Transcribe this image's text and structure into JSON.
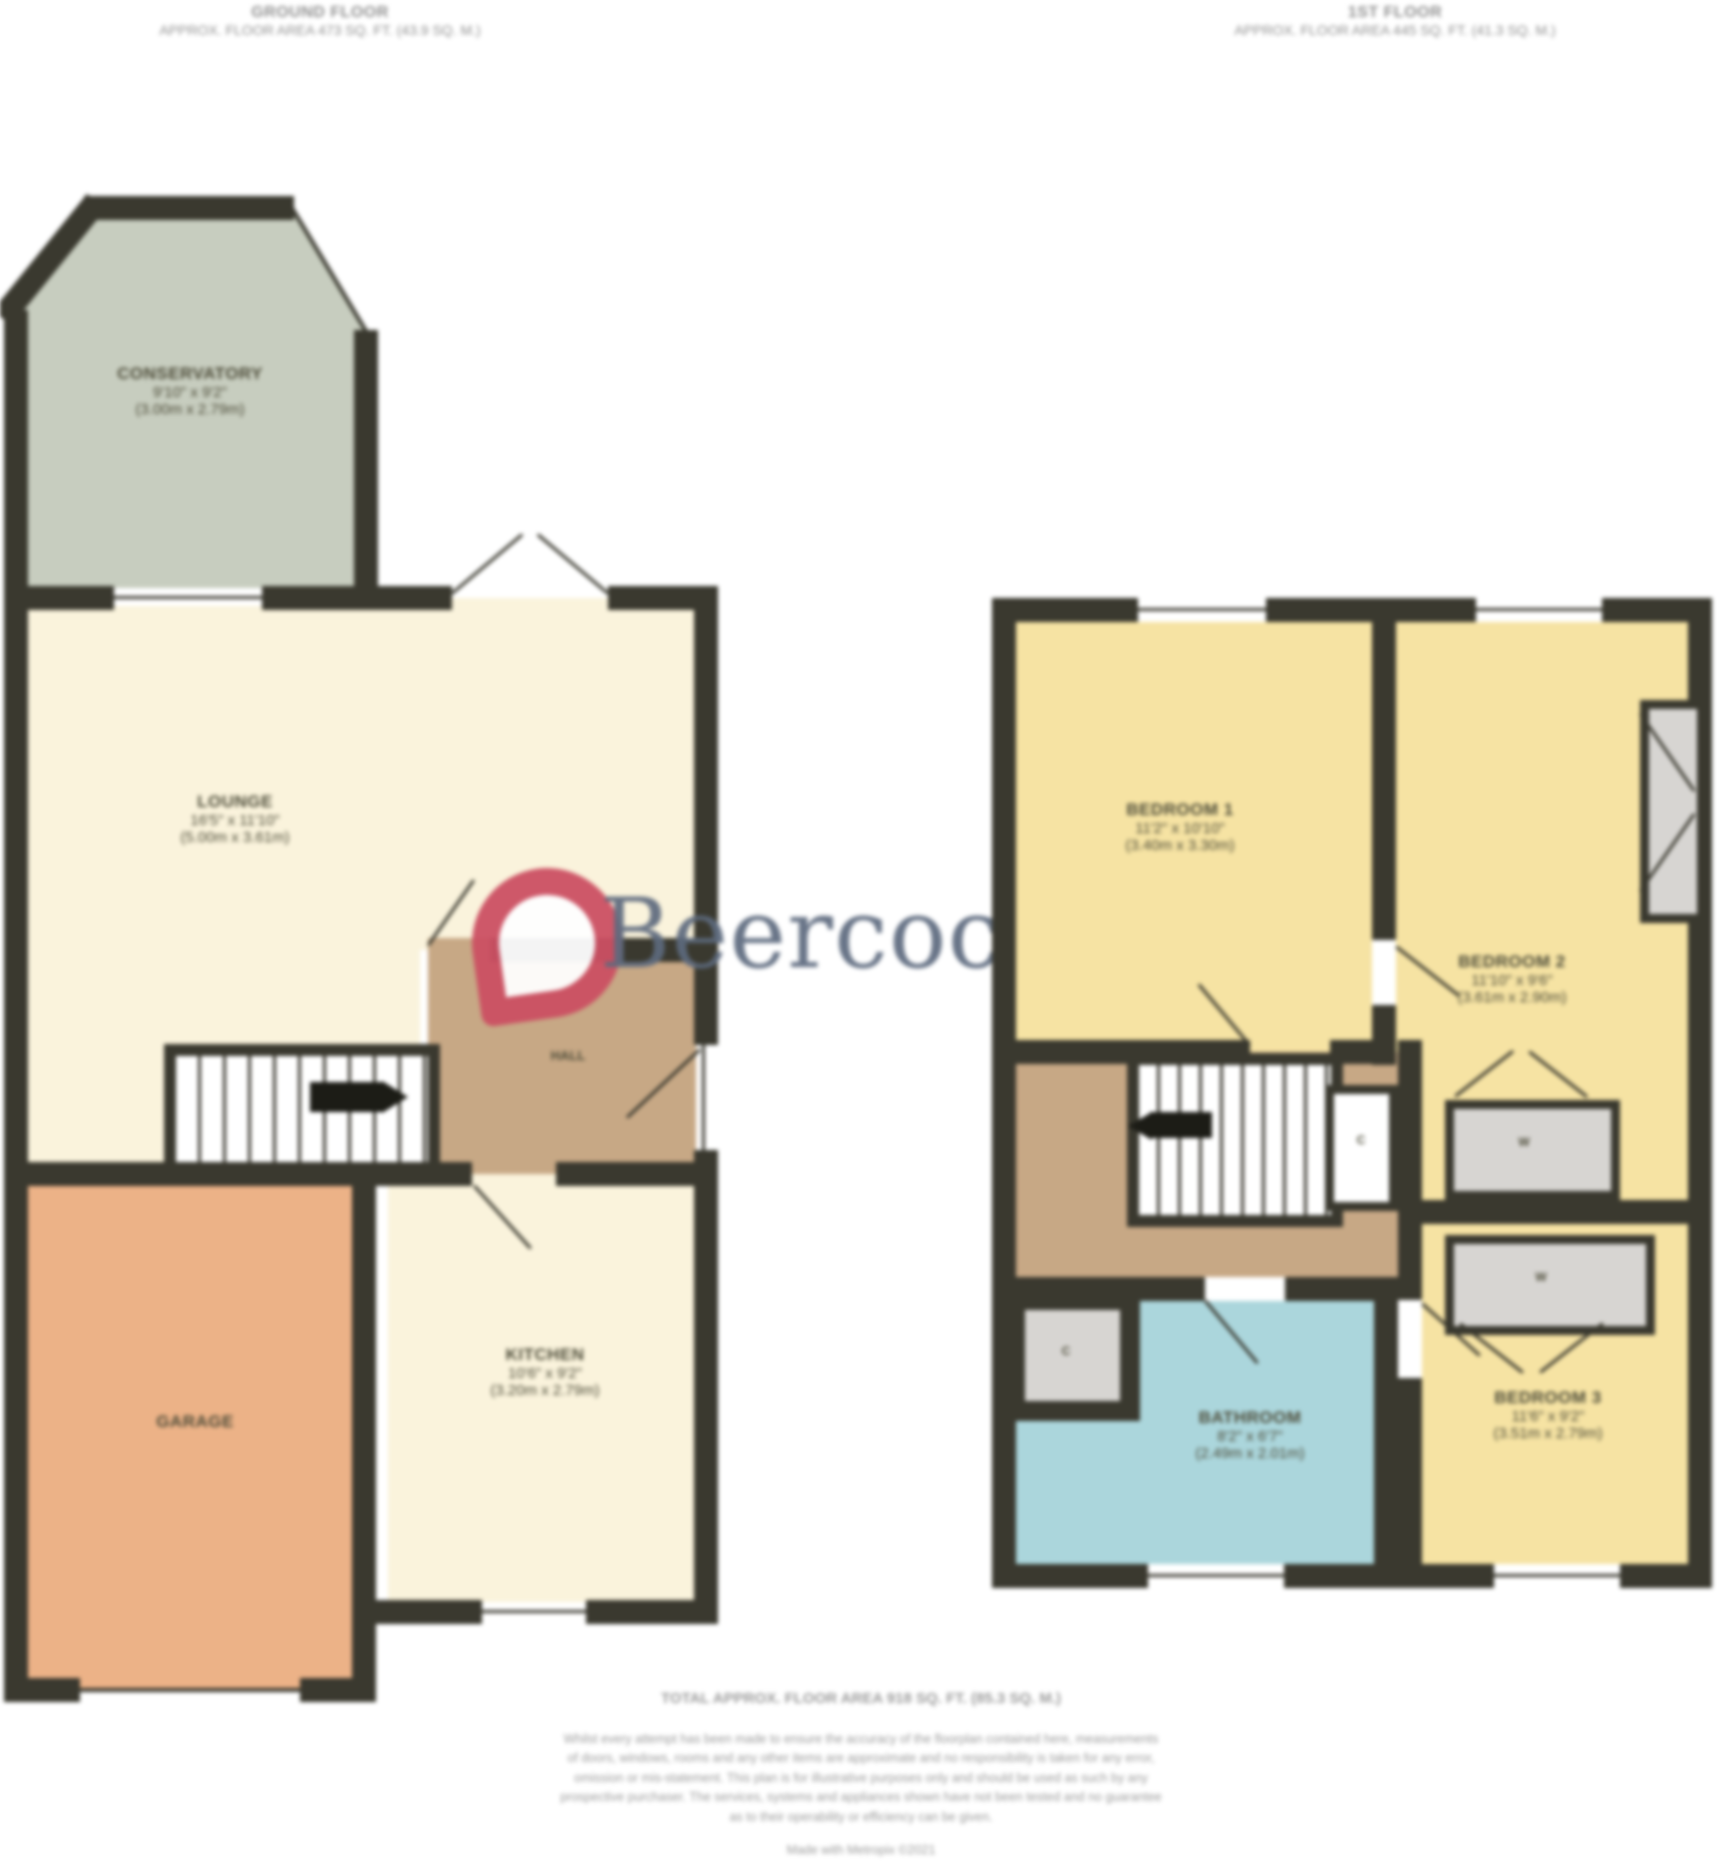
{
  "headers": {
    "ground": {
      "title": "GROUND FLOOR",
      "subtitle": "APPROX. FLOOR AREA 473 SQ. FT. (43.9 SQ. M.)"
    },
    "first": {
      "title": "1ST FLOOR",
      "subtitle": "APPROX. FLOOR AREA 445 SQ. FT. (41.3 SQ. M.)"
    }
  },
  "watermark": {
    "brand": "Beercocks",
    "text_color": "#5d6a7e",
    "logo_color": "#cc5063"
  },
  "ground": {
    "rooms": {
      "conservatory": {
        "name": "CONSERVATORY",
        "dims_ft": "9'10\" x 9'2\"",
        "dims_m": "(3.00m x 2.79m)"
      },
      "lounge": {
        "name": "LOUNGE",
        "dims_ft": "16'5\" x 11'10\"",
        "dims_m": "(5.00m x 3.61m)"
      },
      "hall": {
        "name": "HALL"
      },
      "kitchen": {
        "name": "KITCHEN",
        "dims_ft": "10'6\" x 9'2\"",
        "dims_m": "(3.20m x 2.79m)"
      },
      "garage": {
        "name": "GARAGE"
      }
    }
  },
  "first": {
    "rooms": {
      "bedroom1": {
        "name": "BEDROOM 1",
        "dims_ft": "11'2\" x 10'10\"",
        "dims_m": "(3.40m x 3.30m)"
      },
      "bedroom2": {
        "name": "BEDROOM 2",
        "dims_ft": "11'10\" x 9'6\"",
        "dims_m": "(3.61m x 2.90m)"
      },
      "bedroom3": {
        "name": "BEDROOM 3",
        "dims_ft": "11'6\" x 9'2\"",
        "dims_m": "(3.51m x 2.79m)"
      },
      "bathroom": {
        "name": "BATHROOM",
        "dims_ft": "8'2\" x 6'7\"",
        "dims_m": "(2.49m x 2.01m)"
      },
      "cupboard_label": "C",
      "wardrobe_label": "W"
    }
  },
  "footer": {
    "total": "TOTAL APPROX. FLOOR AREA 918 SQ. FT. (85.3 SQ. M.)",
    "disclaimer_lines": [
      "Whilst every attempt has been made to ensure the accuracy of the floorplan contained here, measurements",
      "of doors, windows, rooms and any other items are approximate and no responsibility is taken for any error,",
      "omission or mis-statement. This plan is for illustrative purposes only and should be used as such by any",
      "prospective purchaser. The services, systems and appliances shown have not been tested and no guarantee",
      "as to their operability or efficiency can be given."
    ],
    "credit": "Made with Metropix ©2021"
  },
  "colors": {
    "wall": "#3a392f",
    "cream": "#faf3dc",
    "green": "#c7cdbf",
    "orange": "#ecb287",
    "tan": "#c7a885",
    "yellow": "#f6e3a3",
    "blue": "#abd6dc",
    "gray": "#d7d5d2"
  }
}
